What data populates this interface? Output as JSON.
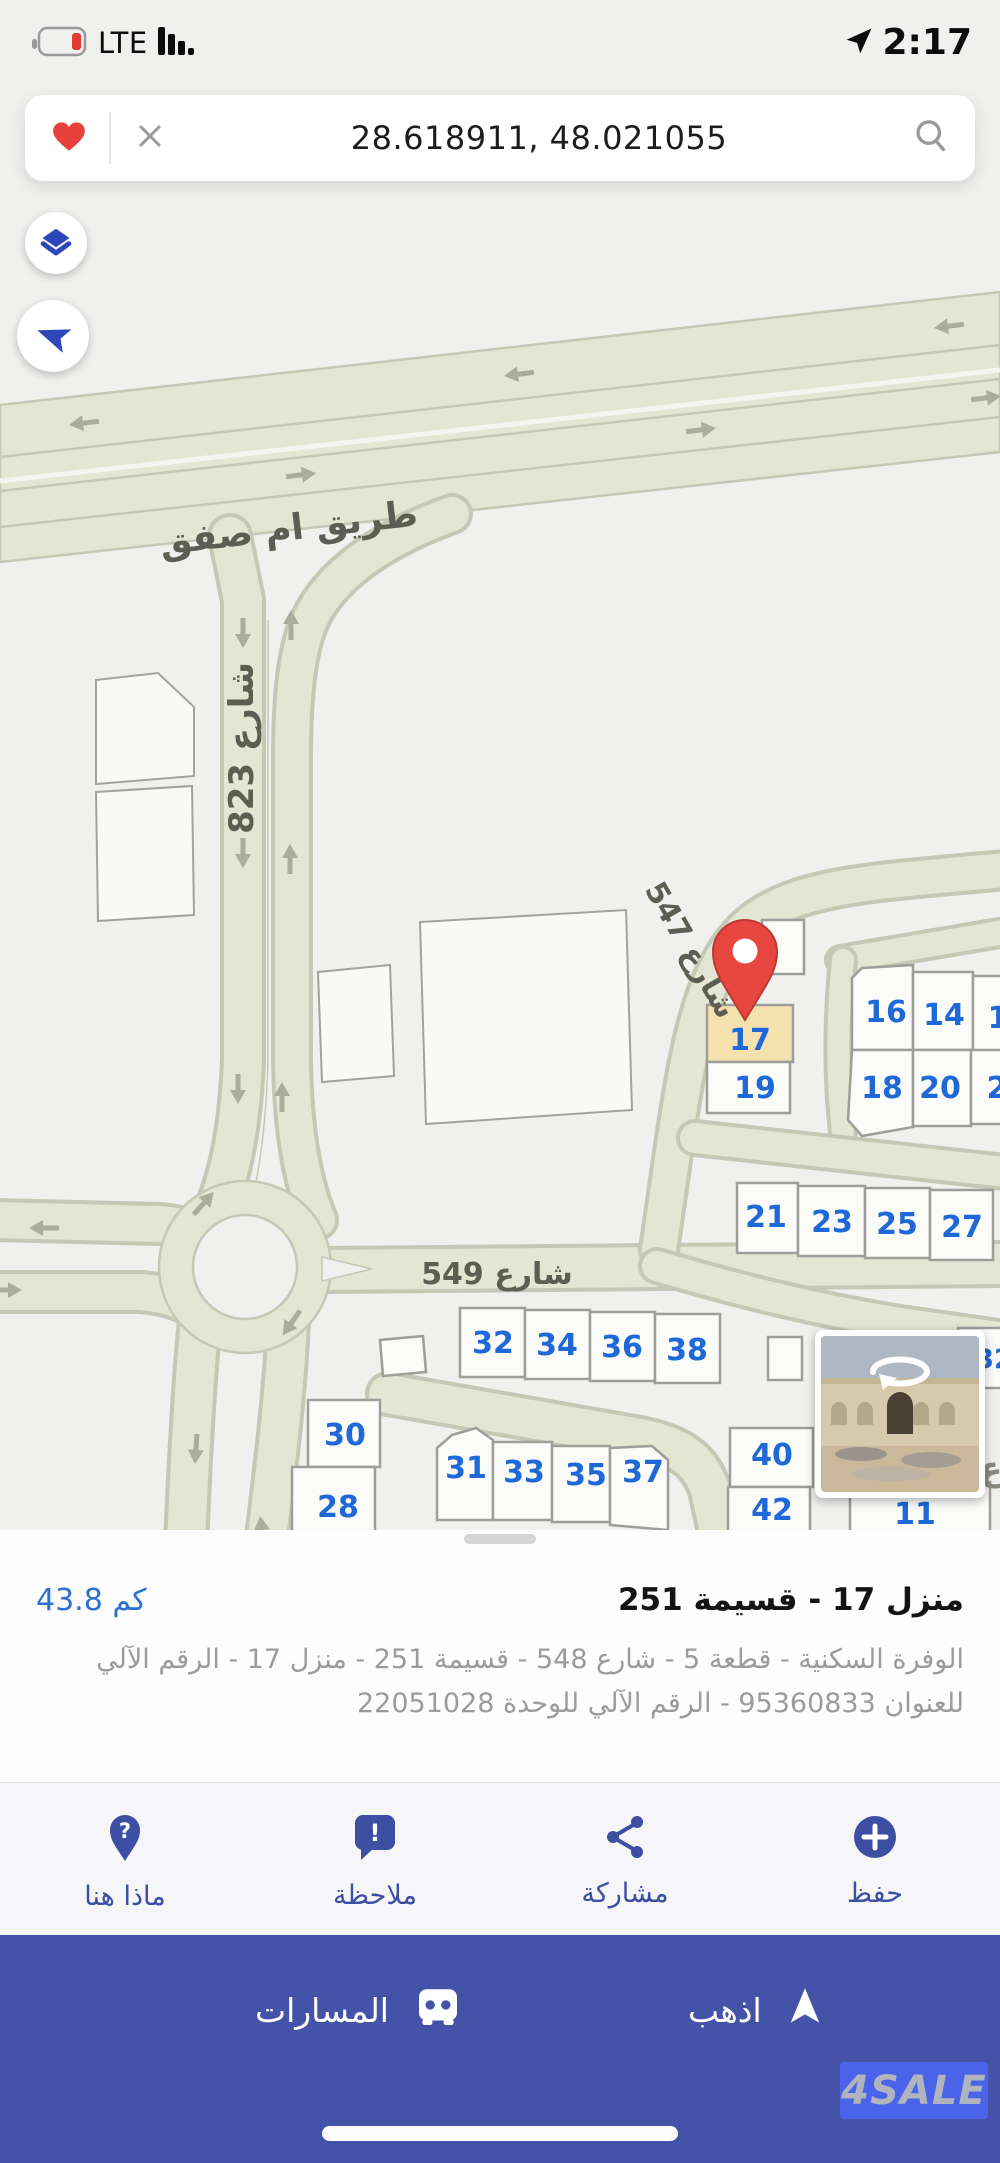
{
  "status": {
    "carrier": "LTE",
    "time": "2:17"
  },
  "search": {
    "query": "28.618911, 48.021055"
  },
  "map": {
    "road_labels": {
      "highway": "طريق ام صفق",
      "s823": "شارع 823",
      "s547": "شارع 547",
      "s549": "شارع 549",
      "partial_letter": "ع"
    },
    "plots": {
      "p17": "17",
      "p19": "19",
      "p16": "16",
      "p14": "14",
      "p12p": "1",
      "p18": "18",
      "p20": "20",
      "p22p": "2",
      "p21": "21",
      "p23": "23",
      "p25": "25",
      "p27": "27",
      "p32": "32",
      "p34": "34",
      "p36": "36",
      "p38": "38",
      "p32b": "32",
      "p30": "30",
      "p28": "28",
      "p31": "31",
      "p33": "33",
      "p35": "35",
      "p37": "37",
      "p40": "40",
      "p42": "42",
      "p11": "11"
    }
  },
  "sheet": {
    "title": "منزل 17 - قسيمة 251",
    "distance": "43.8 كم",
    "description": "الوفرة السكنية - قطعة 5 - شارع 548 - قسيمة 251 - منزل 17 - الرقم الآلي للعنوان 95360833 - الرقم الآلي للوحدة 22051028",
    "actions": {
      "what_here": "ماذا هنا",
      "note": "ملاحظة",
      "share": "مشاركة",
      "save": "حفظ"
    }
  },
  "icons": {
    "question": "?",
    "exclamation": "!"
  },
  "bar": {
    "routes": "المسارات",
    "go": "اذهب"
  },
  "watermark": "4SALE",
  "colors": {
    "accent_blue": "#2d46b9",
    "bar_blue": "#4453a8",
    "pin_red": "#e8473f",
    "plot_number_blue": "#1e68d7",
    "highlighted_plot": "#f6e2ae",
    "road_fill": "#e3e6d2"
  }
}
